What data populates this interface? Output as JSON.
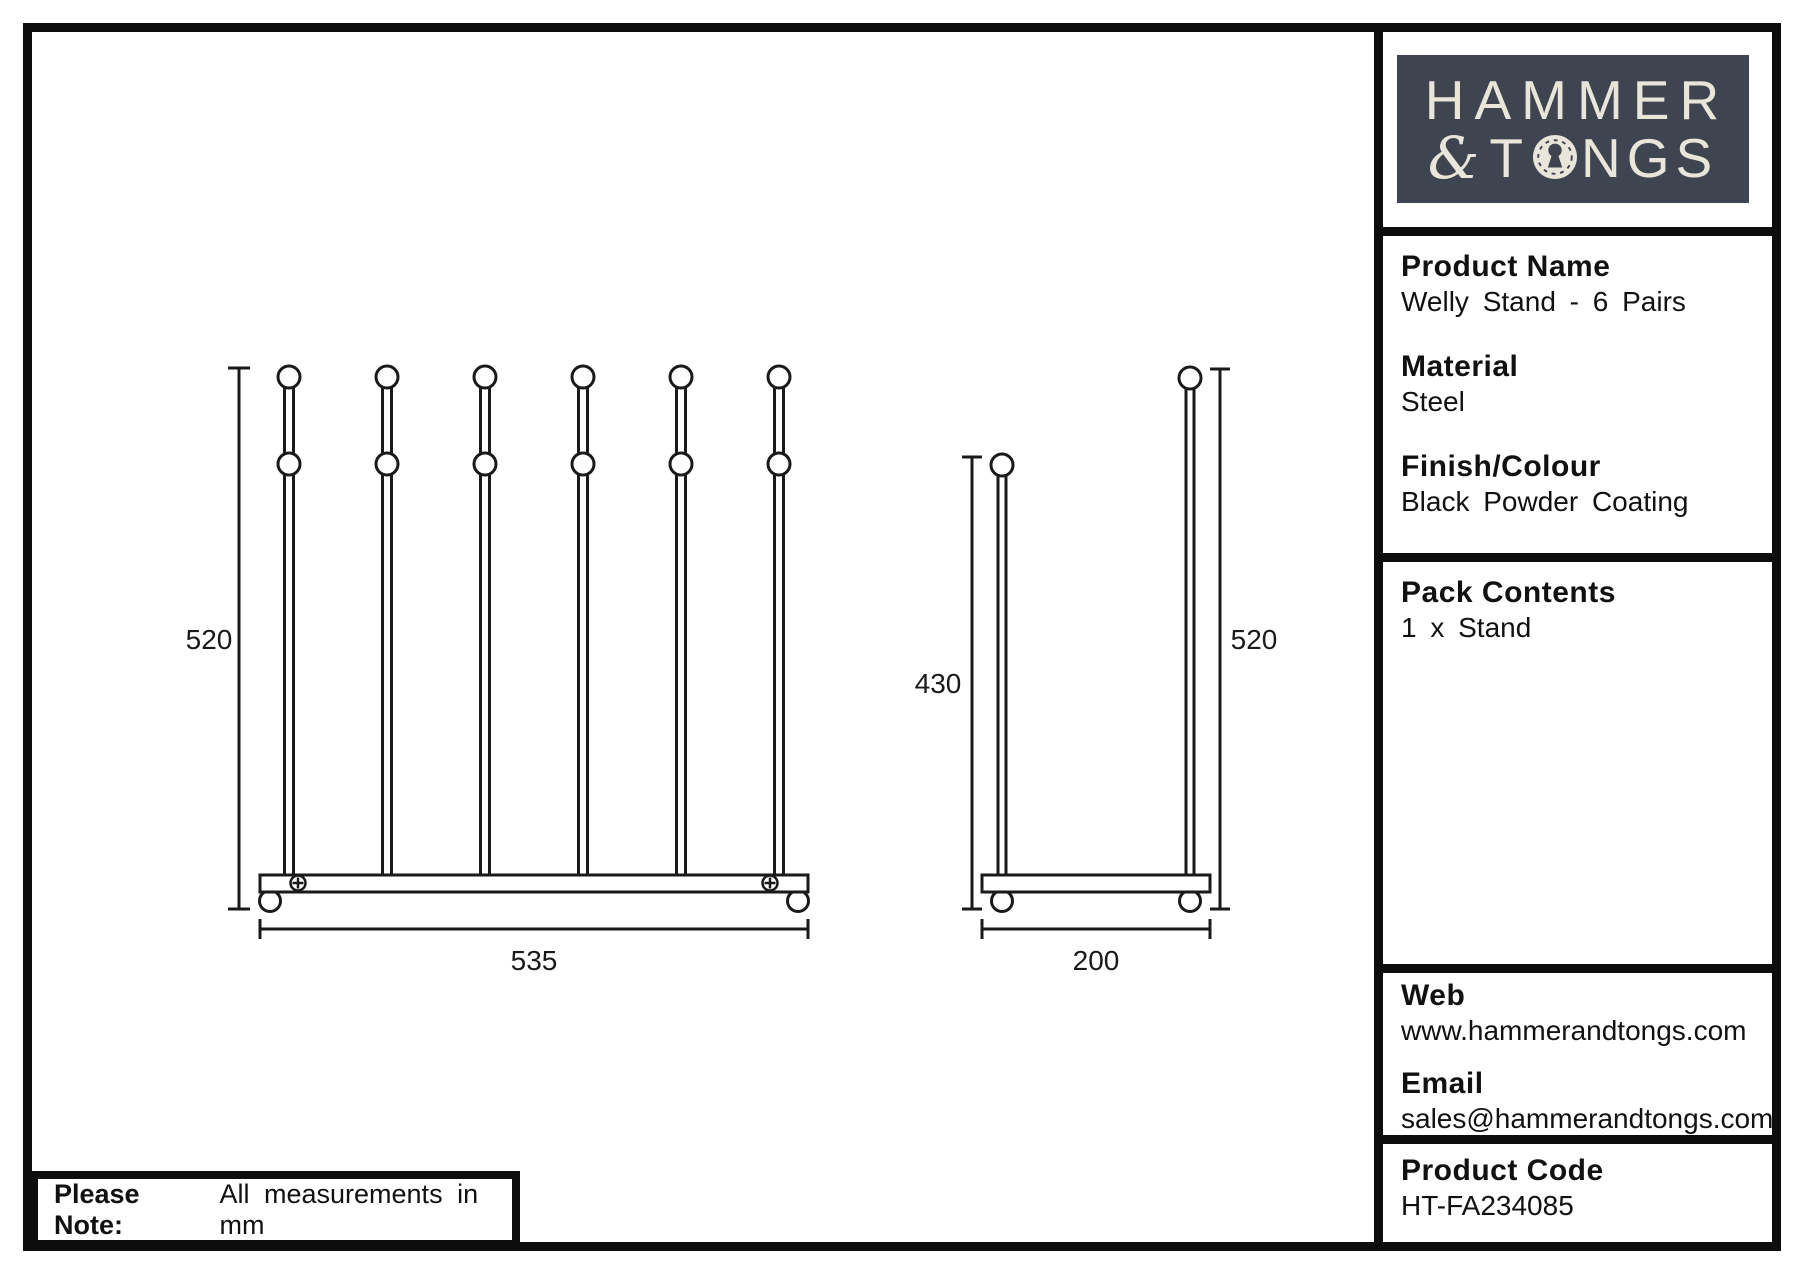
{
  "logo": {
    "line1": "HAMMER",
    "amp": "&",
    "t": "T",
    "ngs": "NGS",
    "bg_color": "#3e4551",
    "fg_color": "#e9e5d9"
  },
  "sidebar": {
    "product_name_label": "Product Name",
    "product_name_value": "Welly Stand - 6 Pairs",
    "material_label": "Material",
    "material_value": "Steel",
    "finish_label": "Finish/Colour",
    "finish_value": "Black Powder Coating",
    "pack_label": "Pack Contents",
    "pack_value": "1 x Stand",
    "web_label": "Web",
    "web_value": "www.hammerandtongs.com",
    "email_label": "Email",
    "email_value": "sales@hammerandtongs.com",
    "code_label": "Product Code",
    "code_value": "HT-FA234085"
  },
  "drawing": {
    "line_color": "#1a1a1a",
    "front_view": {
      "poles": 6,
      "height_label": "520",
      "width_label": "535"
    },
    "side_view": {
      "front_pole_label": "430",
      "back_pole_label": "520",
      "depth_label": "200"
    }
  },
  "note": {
    "label": "Please Note:",
    "text": "All measurements in mm"
  }
}
